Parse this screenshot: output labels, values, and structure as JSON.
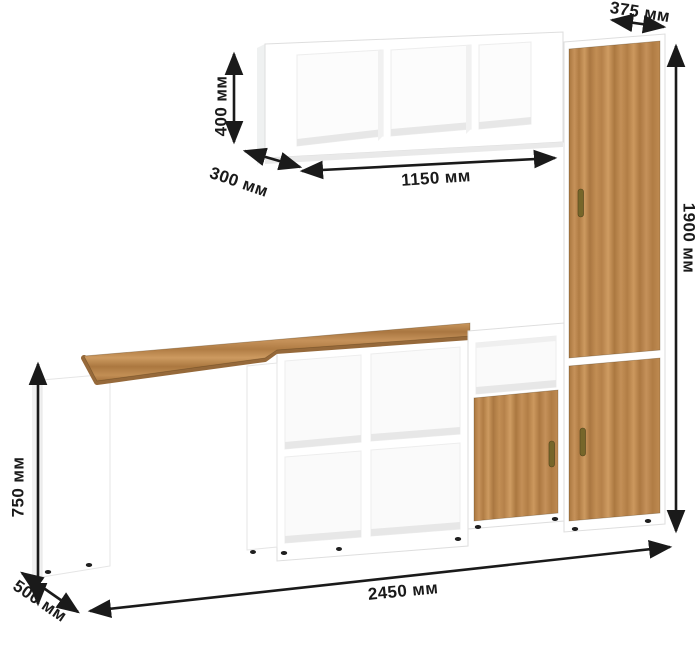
{
  "labels": {
    "shelf_height": "400 мм",
    "shelf_depth": "300 мм",
    "shelf_width": "1150 мм",
    "wardrobe_depth": "375 мм",
    "wardrobe_height": "1900 мм",
    "desk_height": "750 мм",
    "desk_depth": "500 мм",
    "total_width": "2450 мм"
  },
  "colors": {
    "wood": "#b8854c",
    "wood_edge": "#96693a",
    "carcass_white": "#ffffff",
    "inner_shadow": "#e8e8e8",
    "dimension_black": "#1a1a1a",
    "handle_brass": "#76662a"
  }
}
